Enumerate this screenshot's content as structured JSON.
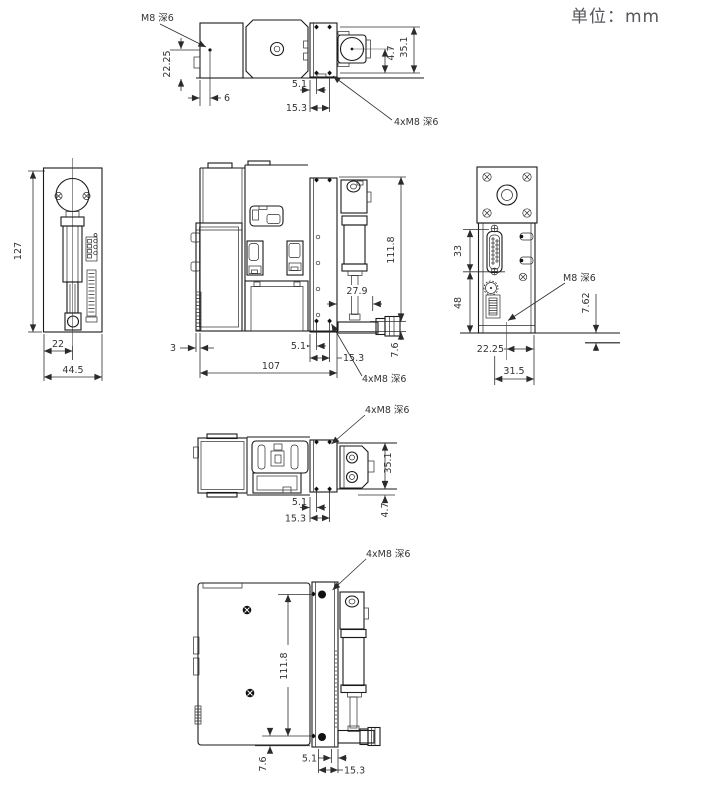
{
  "unit_label": "单位：mm",
  "views": {
    "top": {
      "note_m8": "M8 深6",
      "d_22_25": "22.25",
      "d_6": "6",
      "d_5_1": "5.1",
      "d_15_3": "15.3",
      "d_4_7": "4.7",
      "d_35_1": "35.1",
      "note_4xm8": "4xM8 深6"
    },
    "left": {
      "d_127": "127",
      "d_22": "22",
      "d_44_5": "44.5"
    },
    "front": {
      "d_111_8": "111.8",
      "d_27_9": "27.9",
      "d_3": "3",
      "d_107": "107",
      "d_5_1": "5.1",
      "d_15_3": "15.3",
      "d_7_6": "7.6",
      "note_4xm8": "4xM8 深6"
    },
    "right": {
      "d_33": "33",
      "d_48": "48",
      "d_7_62": "7.62",
      "d_22_25": "22.25",
      "d_31_5": "31.5",
      "note_m8": "M8 深6"
    },
    "bottom": {
      "d_35_1": "35.1",
      "d_4_7": "4.7",
      "d_5_1": "5.1",
      "d_15_3": "15.3",
      "note_4xm8": "4xM8 深6"
    },
    "rear": {
      "d_111_8": "111.8",
      "d_7_6": "7.6",
      "d_5_1": "5.1",
      "d_15_3": "15.3",
      "note_4xm8": "4xM8 深6"
    }
  }
}
